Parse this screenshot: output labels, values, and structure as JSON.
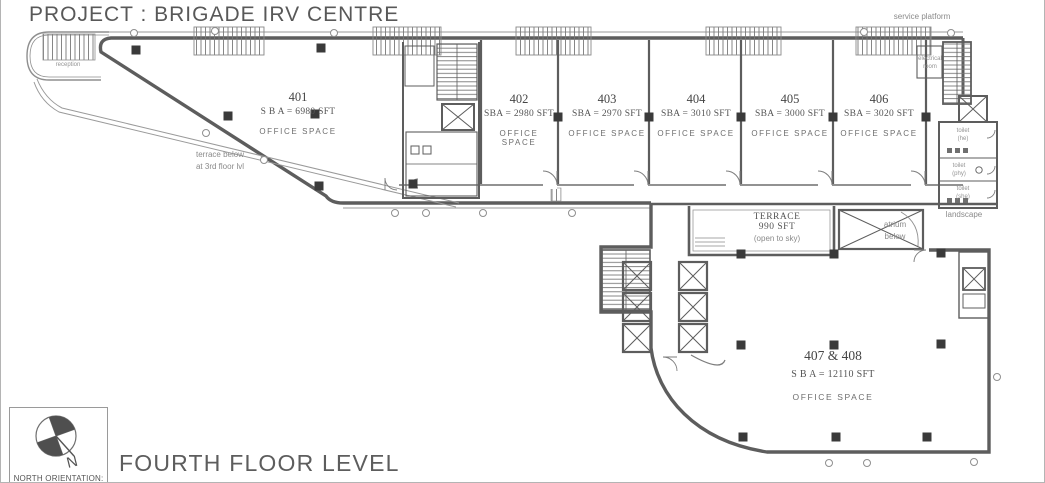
{
  "titles": {
    "project": "PROJECT : BRIGADE IRV CENTRE",
    "floor": "FOURTH FLOOR LEVEL",
    "north_label": "NORTH ORIENTATION:",
    "north_letter": "N"
  },
  "units": [
    {
      "number": "401",
      "area": "S B A = 6980 SFT",
      "type": "OFFICE SPACE"
    },
    {
      "number": "402",
      "area": "SBA = 2980 SFT",
      "type": "OFFICE SPACE"
    },
    {
      "number": "403",
      "area": "SBA = 2970 SFT",
      "type": "OFFICE SPACE"
    },
    {
      "number": "404",
      "area": "SBA = 3010 SFT",
      "type": "OFFICE SPACE"
    },
    {
      "number": "405",
      "area": "SBA = 3000 SFT",
      "type": "OFFICE SPACE"
    },
    {
      "number": "406",
      "area": "SBA = 3020 SFT",
      "type": "OFFICE SPACE"
    },
    {
      "number": "407 & 408",
      "area": "S B A = 12110 SFT",
      "type": "OFFICE SPACE"
    }
  ],
  "annotations": {
    "terrace_below": "terrace below\nat 3rd floor lvl",
    "terrace_title": "TERRACE",
    "terrace_area": "990 SFT",
    "terrace_note": "(open to sky)",
    "atrium": "atrium\nbelow",
    "service_platform": "service platform",
    "landscape": "landscape",
    "reception": "reception",
    "electrical_room": "electrical\nroom",
    "toilet_he": "toilet\n(he)",
    "toilet_phy": "toilet\n(phy)",
    "toilet_she": "toilet\n(she)"
  },
  "colors": {
    "wall": "#5d5d5d",
    "thin_line": "#8f8f8f",
    "column": "#3a3a3a",
    "text_dark": "#4c4c4c",
    "text_light": "#8a8a8a"
  }
}
